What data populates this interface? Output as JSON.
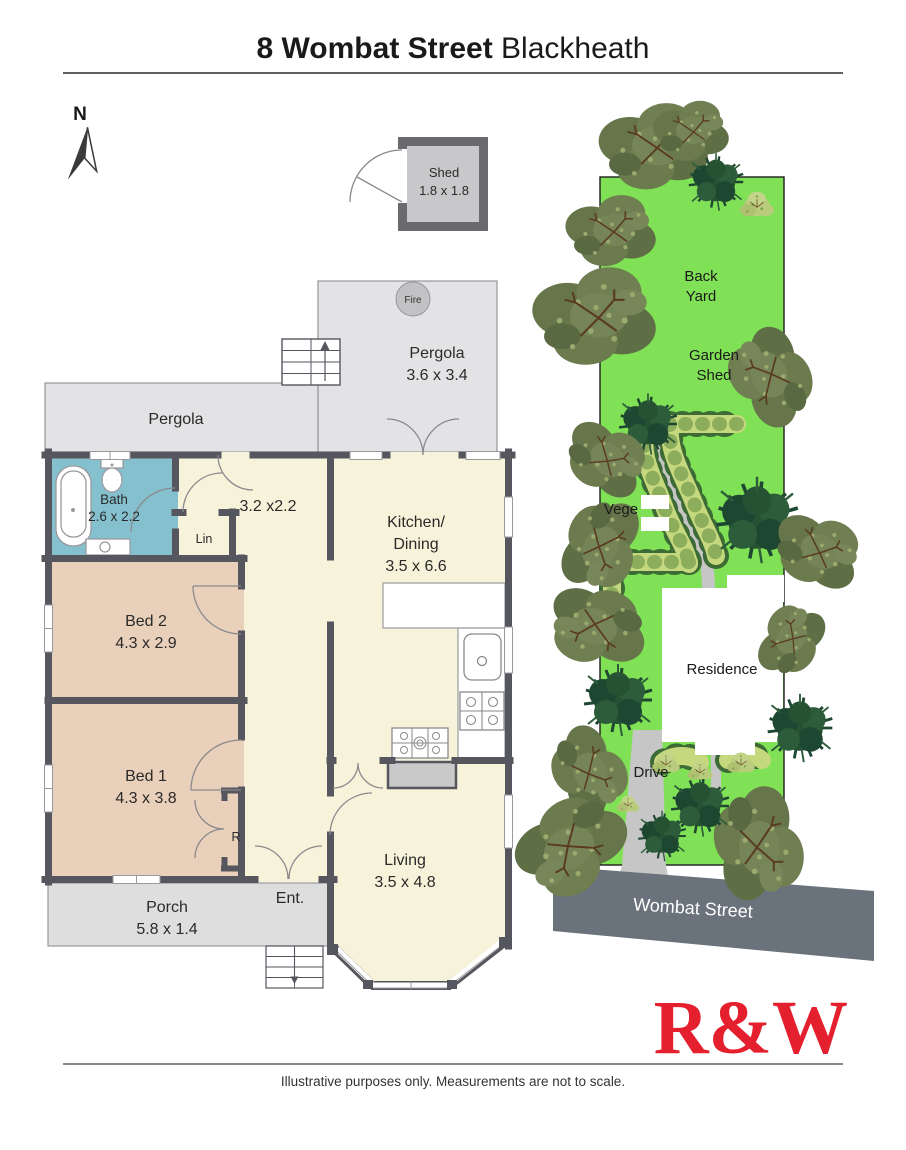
{
  "header": {
    "address": "8 Wombat Street",
    "suburb": " Blackheath"
  },
  "compass": {
    "label": "N"
  },
  "shed": {
    "name": "Shed",
    "dims": "1.8 x 1.8"
  },
  "floor": {
    "pergola_top": {
      "name": "Pergola",
      "dims": "3.6 x 3.4"
    },
    "fire": "Fire",
    "pergola_side": "Pergola",
    "bath": {
      "name": "Bath",
      "dims": "2.6 x 2.2"
    },
    "lin": "Lin",
    "hall_dims": "3.2 x2.2",
    "kitchen": {
      "l1": "Kitchen/",
      "l2": "Dining",
      "dims": "3.5 x 6.6"
    },
    "bed2": {
      "name": "Bed 2",
      "dims": "4.3 x 2.9"
    },
    "bed1": {
      "name": "Bed 1",
      "dims": "4.3 x 3.8"
    },
    "robe": "R",
    "living": {
      "name": "Living",
      "dims": "3.5 x 4.8"
    },
    "porch": {
      "name": "Porch",
      "dims": "5.8 x 1.4"
    },
    "entry": "Ent."
  },
  "site": {
    "back_yard": {
      "l1": "Back",
      "l2": "Yard"
    },
    "garden_shed": {
      "l1": "Garden",
      "l2": "Shed"
    },
    "vege": "Vege",
    "residence": "Residence",
    "drive": "Drive",
    "street": "Wombat Street"
  },
  "brand": {
    "logo": "R&W"
  },
  "footer": {
    "disclaimer": "Illustrative purposes only. Measurements are not to scale."
  },
  "colors": {
    "logo_red": "#e4202e",
    "wall": "#55565e",
    "room_cream": "#f7f3da",
    "room_tan": "#e9d0ba",
    "bath_blue": "#85c0cf",
    "pergola_gray": "#e3e3e5",
    "porch_gray": "#dedede",
    "lawn_green": "#80e156",
    "street_gray": "#6a727b",
    "bed_light_green": "#c6d87e",
    "path_gray": "#c6c6c6"
  }
}
